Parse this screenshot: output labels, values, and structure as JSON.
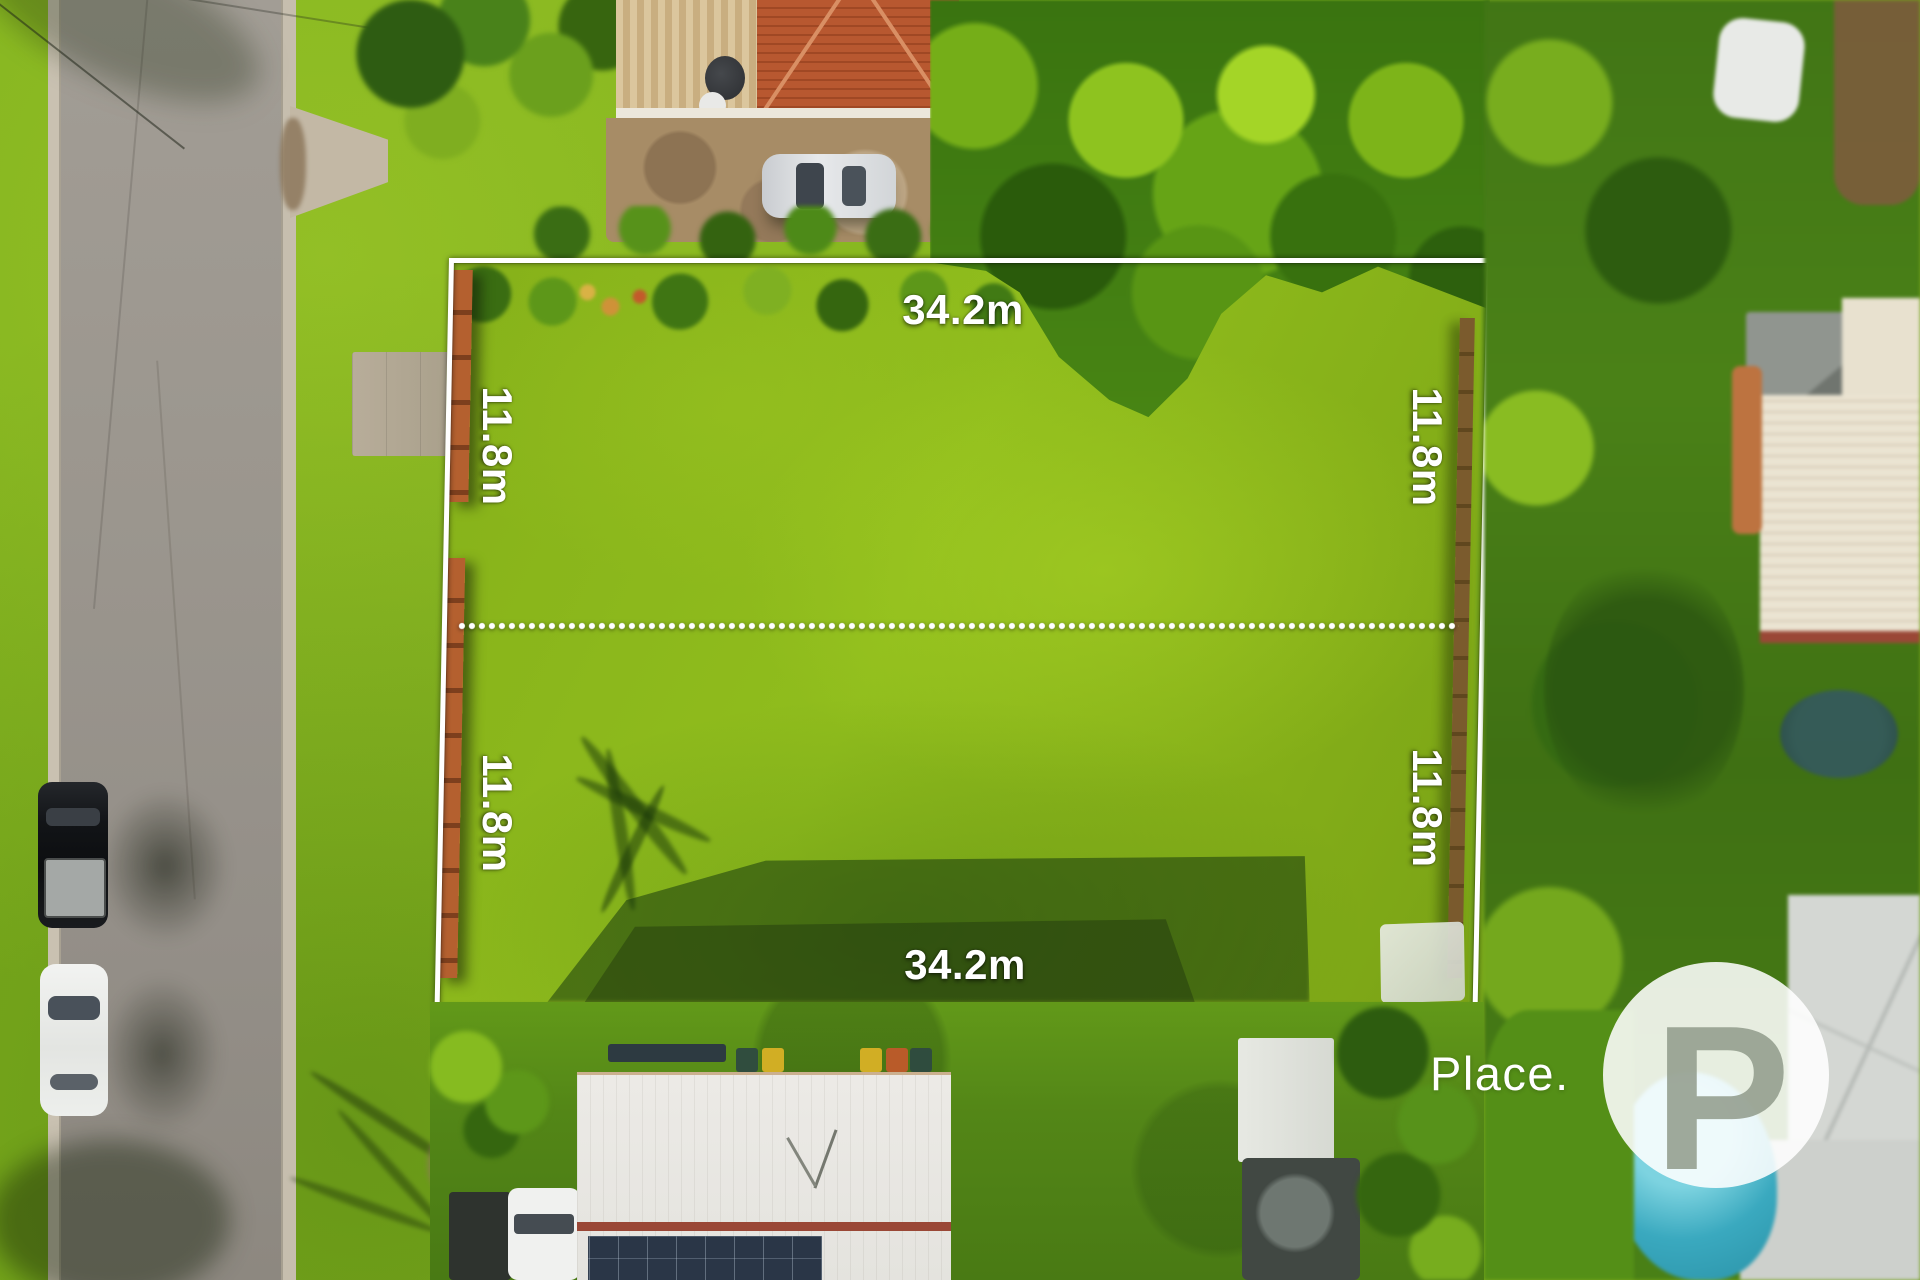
{
  "annotations": {
    "frontage_top": "34.2m",
    "frontage_bottom": "34.2m",
    "side_left_upper": "11.8m",
    "side_left_lower": "11.8m",
    "side_right_upper": "11.8m",
    "side_right_lower": "11.8m"
  },
  "watermark": {
    "brand_text": "Place.",
    "monogram": "P"
  },
  "colors": {
    "boundary_line": "#ffffff",
    "label_text": "#ffffff",
    "watermark": "#ffffff",
    "lot_lawn": "#90bd1d",
    "road_asphalt": "#9b968e",
    "roof_terracotta": "#b2532c",
    "roof_metal_light": "#e4e3de",
    "solar_panel": "#2a3647",
    "pool_teal": "#3aa9bf",
    "vegetation_dark": "#3c7314",
    "vegetation_bright": "#8fc226",
    "fence_timber": "#b4602f",
    "ridge_red": "#9a4736"
  }
}
